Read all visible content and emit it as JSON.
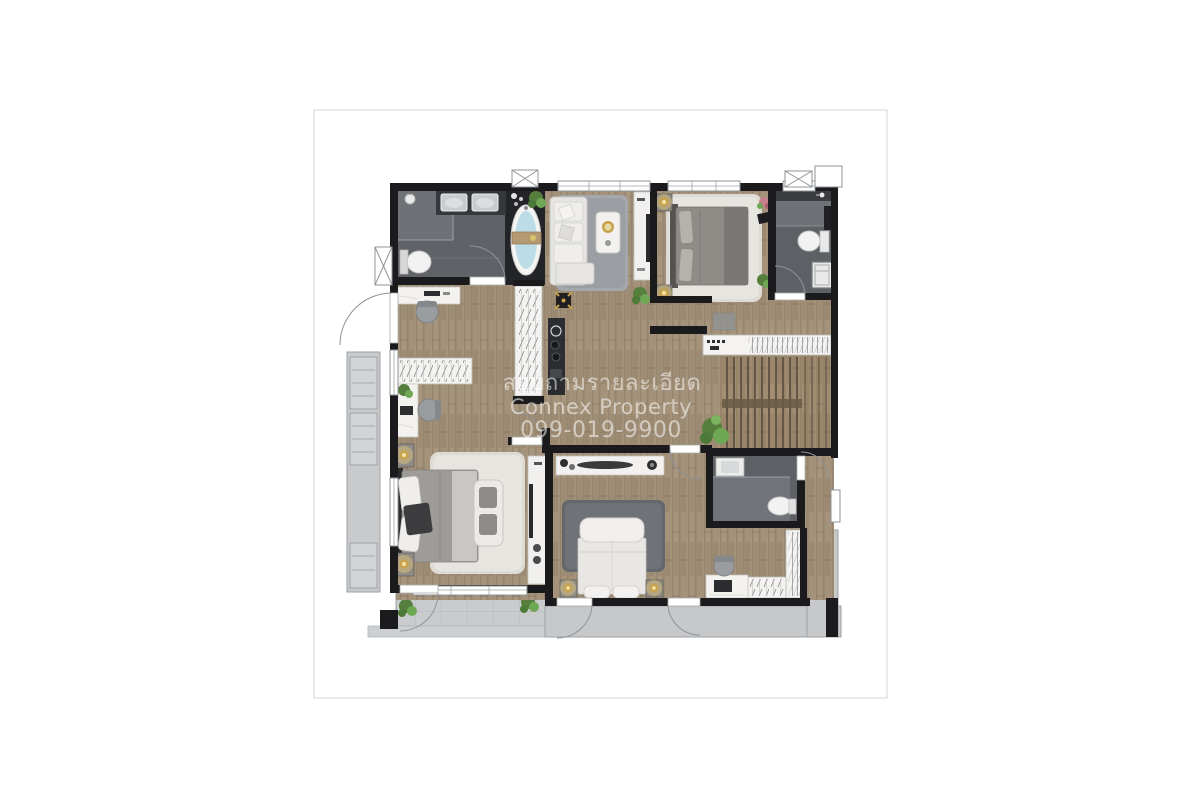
{
  "watermark": {
    "line1": "สอบถามรายละเอียด",
    "line2": "Connex Property",
    "line3": "099-019-9900"
  },
  "palette": {
    "page_background": "#ffffff",
    "card_border": "#e3e3e3",
    "wall": "#1b1b1d",
    "wood_floor": "#a6947c",
    "bathroom_floor": "#5f6267",
    "shower_floor": "#6e7176",
    "tub_platform": "#232427",
    "tub_water": "#bcdde7",
    "balcony": "#c8cacc",
    "balcony_line": "#9ea2a5",
    "rug_gray": "#9b9ea3",
    "rug_white": "#e7e5e0",
    "rug_dark": "#6f7276",
    "furniture_white": "#f1f0ee",
    "gold_accent": "#c9a349",
    "plant_green": "#5f9445",
    "stair_tread": "#5e5142",
    "watermark_text": "rgba(255,255,255,0.55)"
  },
  "furniture_icons": [
    "bathtub-icon",
    "double-sink-vanity-icon",
    "toilet-icon",
    "shower-icon",
    "sofa-icon",
    "coffee-table-icon",
    "tv-console-icon",
    "bed-icon",
    "nightstand-lamp-icon",
    "rug-icon",
    "wardrobe-icon",
    "desk-icon",
    "office-chair-icon",
    "kitchen-counter-icon",
    "dining-table-icon",
    "staircase-icon",
    "closet-rail-icon",
    "plant-icon",
    "ac-condenser-icon",
    "door-swing-icon",
    "window-icon",
    "washer-cabinet-icon",
    "loveseat-icon",
    "tv-shelf-icon",
    "doormat-icon"
  ]
}
